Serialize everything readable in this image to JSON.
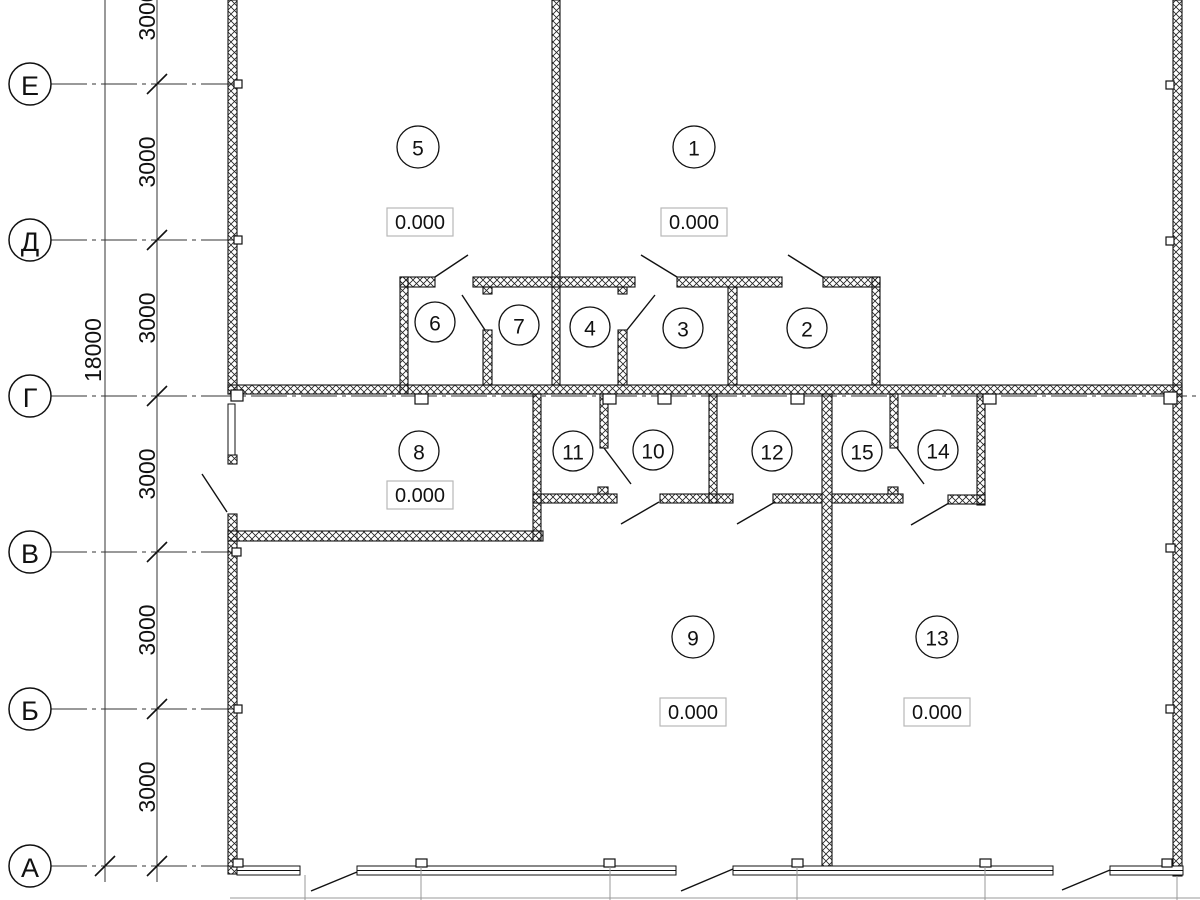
{
  "drawing": {
    "kind": "architectural floor plan",
    "line_color": "#111111",
    "background": "#ffffff"
  },
  "axes": {
    "items": [
      {
        "label": "Е"
      },
      {
        "label": "Д"
      },
      {
        "label": "Г"
      },
      {
        "label": "В"
      },
      {
        "label": "Б"
      },
      {
        "label": "А"
      }
    ]
  },
  "dimensions": {
    "total": "18000",
    "segments": [
      {
        "label": "3000"
      },
      {
        "label": "3000"
      },
      {
        "label": "3000"
      },
      {
        "label": "3000"
      },
      {
        "label": "3000"
      },
      {
        "label": "3000"
      }
    ]
  },
  "rooms": {
    "items": [
      {
        "number": "1"
      },
      {
        "number": "2"
      },
      {
        "number": "3"
      },
      {
        "number": "4"
      },
      {
        "number": "5"
      },
      {
        "number": "6"
      },
      {
        "number": "7"
      },
      {
        "number": "8"
      },
      {
        "number": "9"
      },
      {
        "number": "10"
      },
      {
        "number": "11"
      },
      {
        "number": "12"
      },
      {
        "number": "13"
      },
      {
        "number": "14"
      },
      {
        "number": "15"
      }
    ]
  },
  "elevations": {
    "items": [
      {
        "value": "0.000"
      },
      {
        "value": "0.000"
      },
      {
        "value": "0.000"
      },
      {
        "value": "0.000"
      },
      {
        "value": "0.000"
      }
    ]
  }
}
